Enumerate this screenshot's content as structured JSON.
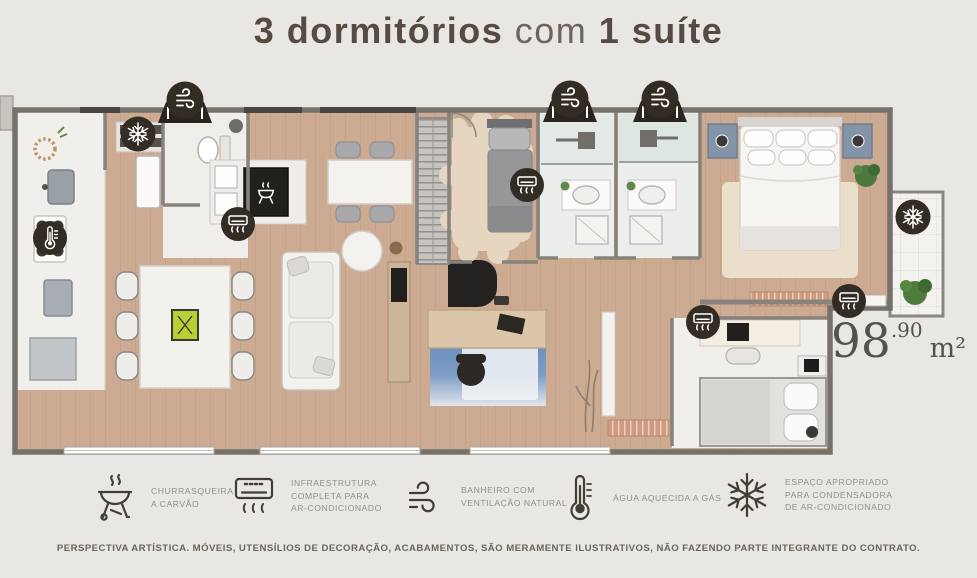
{
  "title": {
    "part1": "3 dormitórios",
    "part2": " com ",
    "part3": "1 suíte"
  },
  "area": {
    "integer": "98",
    "decimal": ".90",
    "unit": "m²"
  },
  "legend": {
    "items": [
      {
        "icon": "grill-icon",
        "lines": [
          "CHURRASQUEIRA",
          "A CARVÃO",
          ""
        ]
      },
      {
        "icon": "ac-unit-icon",
        "lines": [
          "INFRAESTRUTURA",
          "COMPLETA PARA",
          "AR-CONDICIONADO"
        ]
      },
      {
        "icon": "wind-icon",
        "lines": [
          "BANHEIRO COM",
          "VENTILAÇÃO NATURAL",
          ""
        ]
      },
      {
        "icon": "thermometer-icon",
        "lines": [
          "ÁGUA AQUECIDA A GÁS",
          "",
          ""
        ]
      },
      {
        "icon": "snowflake-icon",
        "lines": [
          "ESPAÇO APROPRIADO",
          "PARA CONDENSADORA",
          "DE AR-CONDICIONADO"
        ]
      }
    ]
  },
  "disclaimer": "PERSPECTIVA ARTÍSTICA. MÓVEIS, UTENSÍLIOS DE DECORAÇÃO, ACABAMENTOS, SÃO MERAMENTE ILUSTRATIVOS, NÃO FAZENDO PARTE INTEGRANTE DO CONTRATO.",
  "plan": {
    "badge_icons": [
      "wind",
      "wind",
      "wind",
      "snowflake",
      "snowflake",
      "air-conditioner",
      "air-conditioner",
      "air-conditioner",
      "air-conditioner",
      "thermometer",
      "grill"
    ],
    "colors": {
      "background": "#e9e7e3",
      "badge": "#332c25",
      "wood_floor": "#cdab93",
      "white_floor": "#f1efeb",
      "title_text": "#564b42",
      "legend_text": "#978e87",
      "rug_blue": "#5f83b8",
      "nightstand_blue": "#8494a8"
    }
  }
}
